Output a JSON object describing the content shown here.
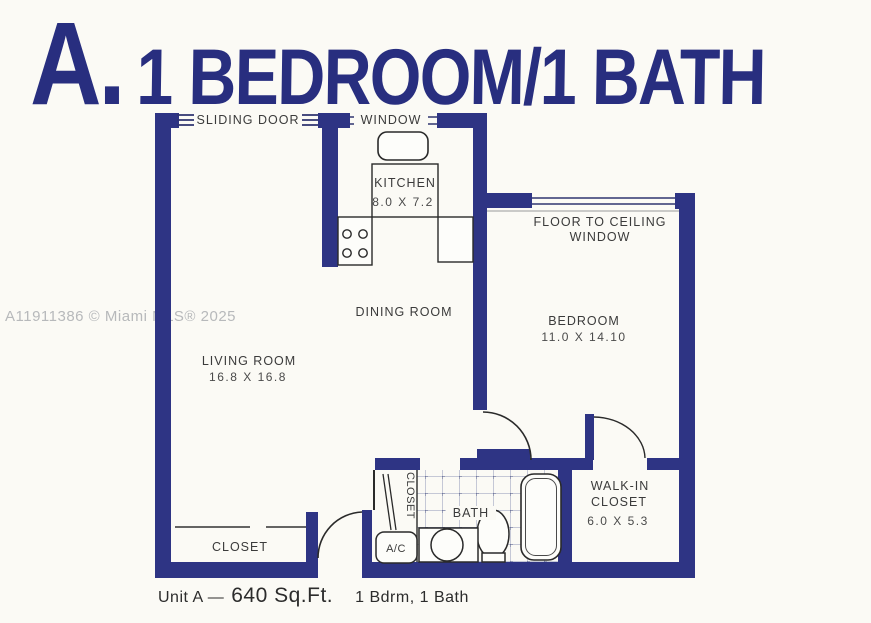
{
  "title": {
    "letter": "A.",
    "text": "1 BEDROOM/1 BATH",
    "color": "#282e7f"
  },
  "watermark": {
    "text": "A11911386 © Miami MLS® 2025"
  },
  "plan": {
    "wall_color": "#2e3484",
    "labels": {
      "sliding_door": "SLIDING DOOR",
      "kitchen_window": "WINDOW",
      "kitchen_name": "KITCHEN",
      "kitchen_dims": "8.0 X 7.2",
      "ftc_window_line1": "FLOOR TO CEILING",
      "ftc_window_line2": "WINDOW",
      "dining_room": "DINING ROOM",
      "living_room_name": "LIVING ROOM",
      "living_room_dims": "16.8 X 16.8",
      "bedroom_name": "BEDROOM",
      "bedroom_dims": "11.0 X 14.10",
      "bath": "BATH",
      "hall_closet": "CLOSET",
      "ac_unit": "A/C",
      "walkin_line1": "WALK-IN",
      "walkin_line2": "CLOSET",
      "walkin_dims": "6.0 X 5.3",
      "entry_closet": "CLOSET"
    }
  },
  "caption": {
    "prefix": "Unit A —",
    "sqft": "640 Sq.Ft.",
    "suffix": "1 Bdrm, 1 Bath"
  }
}
